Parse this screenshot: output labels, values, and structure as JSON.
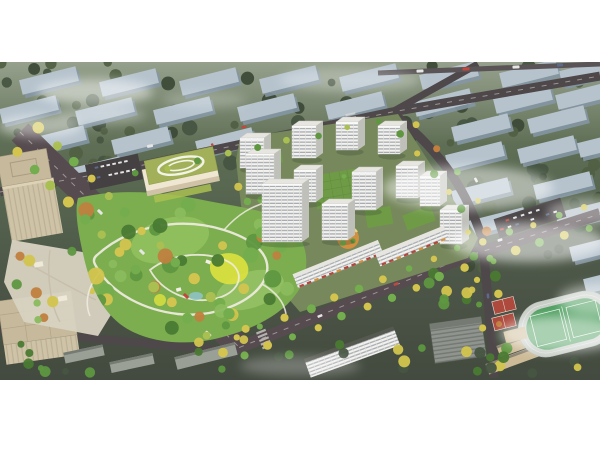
{
  "palette": {
    "white": "#ffffff",
    "base_top": "#6d7c60",
    "base_mid": "#5a6a52",
    "base_low": "#4d5748",
    "base_bottom": "#434a3f",
    "faded_slab_top": "#b6c3cd",
    "faded_slab_side": "#8496a4",
    "tree_dark1": "#3c4a37",
    "tree_dark2": "#465541",
    "tree_dark3": "#516043",
    "road": "#4e484a",
    "road_blvd": "#564c50",
    "road_top": "#5a5456",
    "lane": "#d8d4d0",
    "park_base": "#7cad4e",
    "park_light": "#93c262",
    "park_light2": "#a4cc72",
    "park_yellow": "#d9df3f",
    "path": "#efece1",
    "pond": "#8fc3cd",
    "t_green1": "#4a7a33",
    "t_green2": "#5e9740",
    "t_green3": "#74ad4d",
    "t_green4": "#8abb5d",
    "t_yellow": "#d2c44e",
    "t_orange": "#c07f3e",
    "t_lime": "#aabf52",
    "tower_face": "#f3f2ee",
    "tower_side": "#bfc0ba",
    "tower_roof": "#e6e5e0",
    "tower_roof_edge": "#cac9c3",
    "tower_window": "#99a0a7",
    "podium": "#6f9b47",
    "podium_line": "#5d8a3c",
    "school_wall": "#efe7d1",
    "school_wall_shade": "#cfc2a6",
    "school_roof": "#a2b05a",
    "school_roof_line": "#f2f4e6",
    "parking": "#454041",
    "beige_wall": "#cfc3a7",
    "beige_roof": "#c6b99c",
    "beige_line": "#aa9d81",
    "plaza": "#d8d2c1",
    "grey_bld": "#9aa096",
    "grey_roof": "#757b72",
    "grey_office": "#8f948e",
    "grey_office_line": "#6e736c",
    "white_slab_roof": "#56594f",
    "track": "#c9cfc8",
    "field": "#4f9f60",
    "court_red": "#ad4a3d",
    "tan_school": "#cdbb97",
    "tan_edge": "#8d8472",
    "awning_red": "#b5463f",
    "court_orange": "#d68f3e",
    "dev_ground": "#76885c",
    "car_white": "#e6e6e6",
    "car_red": "#c0483e",
    "car_blue": "#5a6b8c",
    "fog": "#ffffff"
  },
  "scene": {
    "frame": {
      "width": 600,
      "height": 450,
      "content_top": 62,
      "content_height": 318
    },
    "faded_slabs": [
      [
        20,
        73
      ],
      [
        100,
        75
      ],
      [
        180,
        74
      ],
      [
        260,
        72
      ],
      [
        340,
        70
      ],
      [
        420,
        68
      ],
      [
        500,
        66
      ],
      [
        560,
        64
      ],
      [
        0,
        102
      ],
      [
        76,
        104
      ],
      [
        154,
        103
      ],
      [
        238,
        100
      ],
      [
        326,
        98
      ],
      [
        414,
        95
      ],
      [
        494,
        92
      ],
      [
        556,
        88
      ],
      [
        28,
        132
      ],
      [
        112,
        133
      ],
      [
        196,
        134
      ],
      [
        452,
        120
      ],
      [
        528,
        112
      ],
      [
        2,
        160
      ],
      [
        64,
        163
      ],
      [
        446,
        148
      ],
      [
        518,
        142
      ],
      [
        578,
        136
      ],
      [
        452,
        184
      ],
      [
        534,
        178
      ],
      [
        468,
        214
      ],
      [
        556,
        206
      ],
      [
        570,
        240
      ],
      [
        584,
        272
      ]
    ],
    "tree_regions": [
      {
        "r": [
          0,
          62,
          600,
          105
        ],
        "n": 64,
        "rad": [
          3.5,
          8
        ],
        "cols": [
          "tree_dark1",
          "tree_dark2",
          "tree_dark3"
        ],
        "seed": 3,
        "g": "g-bgtrees"
      },
      {
        "r": [
          432,
          168,
          168,
          112
        ],
        "n": 24,
        "rad": [
          3.5,
          8
        ],
        "cols": [
          "tree_dark1",
          "tree_dark2",
          "tree_dark3"
        ],
        "seed": 5,
        "g": "g-bgtrees"
      },
      {
        "r": [
          0,
          118,
          148,
          66
        ],
        "n": 12,
        "rad": [
          3.5,
          7
        ],
        "cols": [
          "tree_dark2",
          "tree_dark3"
        ],
        "seed": 9,
        "g": "g-bgtrees"
      },
      {
        "r": [
          84,
          198,
          226,
          140
        ],
        "n": 46,
        "rad": [
          4,
          9
        ],
        "cols": [
          "t_green1",
          "t_green2",
          "t_green3",
          "t_green4",
          "t_yellow",
          "t_orange"
        ],
        "seed": 21,
        "g": "g-parktrees"
      },
      {
        "r": [
          238,
          150,
          56,
          62
        ],
        "n": 8,
        "rad": [
          3,
          6
        ],
        "cols": [
          "t_green2",
          "t_green3",
          "t_yellow"
        ],
        "seed": 27,
        "g": "g-devtrees"
      },
      {
        "r": [
          16,
          248,
          96,
          72
        ],
        "n": 12,
        "rad": [
          3,
          6
        ],
        "cols": [
          "t_green2",
          "t_green4",
          "t_yellow",
          "t_orange"
        ],
        "seed": 35,
        "g": "g-plazatrees"
      },
      {
        "r": [
          0,
          338,
          600,
          36
        ],
        "n": 30,
        "rad": [
          3,
          6
        ],
        "cols": [
          "tree_dark2",
          "t_green1",
          "t_green2",
          "t_yellow"
        ],
        "seed": 31,
        "g": "g-bottomtrees"
      },
      {
        "r": [
          428,
          258,
          70,
          56
        ],
        "n": 9,
        "rad": [
          3,
          6
        ],
        "cols": [
          "t_green1",
          "t_green2",
          "t_yellow"
        ],
        "seed": 33,
        "g": "g-bottomtrees"
      }
    ],
    "roads": [
      {
        "d": "M 0,192 L 120,170 L 392,112 L 600,76",
        "w": 9,
        "c": "road"
      },
      {
        "d": "M 392,112 L 478,64",
        "w": 7,
        "c": "road"
      },
      {
        "d": "M 378,73 L 600,64",
        "w": 5,
        "c": "road_top"
      },
      {
        "d": "M 394,114 C 448,158 468,196 482,238 C 486,270 488,305 492,345 L 494,378",
        "w": 9,
        "c": "road"
      },
      {
        "d": "M 20,132 L 242,350",
        "w": 24,
        "c": "road_blvd"
      },
      {
        "d": "M 228,352 L 468,256 L 600,214",
        "w": 12,
        "c": "road_blvd"
      },
      {
        "d": "M 0,330 L 230,351",
        "w": 8,
        "c": "road"
      }
    ],
    "lanes": [
      {
        "d": "M 20,132 L 242,350"
      },
      {
        "d": "M 228,352 L 468,256 L 600,214"
      },
      {
        "d": "M 0,192 L 120,170 L 392,112 L 600,76"
      }
    ],
    "crosswalks": [
      {
        "x": 96,
        "y": 206,
        "rot": 45
      },
      {
        "x": 190,
        "y": 300,
        "rot": 45
      },
      {
        "x": 352,
        "y": 122,
        "rot": 78
      },
      {
        "x": 264,
        "y": 339,
        "rot": 68
      }
    ],
    "towers": [
      [
        240,
        138,
        24,
        30
      ],
      [
        292,
        126,
        24,
        32
      ],
      [
        336,
        122,
        22,
        28
      ],
      [
        378,
        126,
        22,
        28
      ],
      [
        246,
        154,
        28,
        40
      ],
      [
        294,
        170,
        22,
        32
      ],
      [
        352,
        172,
        24,
        38
      ],
      [
        396,
        166,
        22,
        32
      ],
      [
        262,
        184,
        40,
        58
      ],
      [
        322,
        204,
        26,
        36
      ],
      [
        420,
        176,
        20,
        30
      ],
      [
        440,
        210,
        22,
        34
      ]
    ],
    "slabs": [
      {
        "cx": 338,
        "cy": 264,
        "rot": -22,
        "w": 92,
        "h": 15,
        "kind": "shop"
      },
      {
        "cx": 412,
        "cy": 246,
        "rot": -22,
        "w": 74,
        "h": 14,
        "kind": "shop"
      },
      {
        "cx": 352,
        "cy": 352,
        "rot": -20,
        "w": 95,
        "h": 20,
        "kind": "white"
      },
      {
        "cx": 206,
        "cy": 356,
        "rot": -14,
        "w": 62,
        "h": 13,
        "kind": "grey"
      },
      {
        "cx": 84,
        "cy": 354,
        "rot": -12,
        "w": 40,
        "h": 11,
        "kind": "grey"
      },
      {
        "cx": 132,
        "cy": 363,
        "rot": -12,
        "w": 44,
        "h": 11,
        "kind": "grey"
      },
      {
        "cx": 536,
        "cy": 338,
        "rot": -20,
        "w": 80,
        "h": 12,
        "kind": "tan"
      },
      {
        "cx": 524,
        "cy": 356,
        "rot": -20,
        "w": 78,
        "h": 11,
        "kind": "tan"
      }
    ],
    "lots": [
      {
        "cx": 114,
        "cy": 172,
        "rot": -12,
        "w": 54,
        "h": 26,
        "rows": 2,
        "cols": 8,
        "seed": 41
      },
      {
        "cx": 530,
        "cy": 218,
        "rot": -18,
        "w": 70,
        "h": 20,
        "rows": 2,
        "cols": 8,
        "seed": 43
      }
    ],
    "street_trees": [
      {
        "pts": [
          [
            20,
            132
          ],
          [
            242,
            350
          ]
        ],
        "n": 13,
        "off": -16,
        "rad": 4.5,
        "cols": [
          "t_yellow",
          "t_lime",
          "t_green3"
        ],
        "seed": 7
      },
      {
        "pts": [
          [
            20,
            132
          ],
          [
            242,
            350
          ]
        ],
        "n": 13,
        "off": 16,
        "rad": 4.5,
        "cols": [
          "t_yellow",
          "t_green3",
          "t_lime"
        ],
        "seed": 11
      },
      {
        "pts": [
          [
            228,
            352
          ],
          [
            468,
            256
          ],
          [
            600,
            214
          ]
        ],
        "n": 15,
        "off": -10,
        "rad": 3.8,
        "cols": [
          "t_yellow",
          "t_green3"
        ],
        "seed": 13
      },
      {
        "pts": [
          [
            228,
            352
          ],
          [
            468,
            256
          ],
          [
            600,
            214
          ]
        ],
        "n": 15,
        "off": 10,
        "rad": 3.8,
        "cols": [
          "t_green3",
          "t_yellow"
        ],
        "seed": 17
      },
      {
        "pts": [
          [
            120,
            170
          ],
          [
            392,
            112
          ]
        ],
        "n": 9,
        "off": 7,
        "rad": 3.2,
        "cols": [
          "t_green2",
          "t_lime"
        ],
        "seed": 19
      },
      {
        "pts": [
          [
            400,
            120
          ],
          [
            470,
            200
          ],
          [
            486,
            268
          ],
          [
            492,
            340
          ]
        ],
        "n": 10,
        "off": 9,
        "rad": 3.4,
        "cols": [
          "t_green2",
          "t_yellow"
        ],
        "seed": 23
      },
      {
        "pts": [
          [
            400,
            120
          ],
          [
            470,
            200
          ],
          [
            486,
            268
          ],
          [
            492,
            340
          ]
        ],
        "n": 8,
        "off": -9,
        "rad": 3.6,
        "cols": [
          "t_yellow",
          "t_orange",
          "t_green3"
        ],
        "seed": 29
      }
    ],
    "cars": [
      [
        150,
        146,
        -12,
        6,
        3,
        "car_white"
      ],
      [
        244,
        127,
        -12,
        5,
        2.5,
        "car_red"
      ],
      [
        100,
        212,
        44,
        6,
        3,
        "car_white"
      ],
      [
        142,
        252,
        44,
        6,
        3,
        "car_white"
      ],
      [
        186,
        296,
        44,
        6,
        3,
        "car_red"
      ],
      [
        208,
        334,
        44,
        7,
        3.5,
        "car_white"
      ],
      [
        320,
        316,
        -22,
        5,
        2.5,
        "car_white"
      ],
      [
        396,
        284,
        -22,
        5,
        2.5,
        "car_red"
      ],
      [
        500,
        240,
        -17,
        5,
        2.5,
        "car_white"
      ],
      [
        476,
        180,
        62,
        5,
        2.5,
        "car_white"
      ],
      [
        488,
        296,
        86,
        5,
        2.5,
        "car_blue"
      ],
      [
        420,
        71,
        -2,
        7,
        3,
        "car_white"
      ],
      [
        466,
        69,
        -2,
        7,
        3,
        "car_red"
      ],
      [
        516,
        67,
        -2,
        7,
        3,
        "car_white"
      ],
      [
        560,
        65,
        -2,
        6,
        3,
        "car_blue"
      ]
    ],
    "fog": [
      [
        95,
        92,
        58,
        13,
        0.5
      ],
      [
        40,
        126,
        42,
        11,
        0.45
      ],
      [
        350,
        80,
        70,
        12,
        0.28
      ],
      [
        468,
        188,
        85,
        22,
        0.5
      ],
      [
        528,
        242,
        78,
        20,
        0.55
      ],
      [
        588,
        212,
        42,
        14,
        0.4
      ],
      [
        562,
        334,
        62,
        18,
        0.52
      ],
      [
        600,
        300,
        42,
        16,
        0.45
      ],
      [
        100,
        115,
        45,
        9,
        0.3
      ],
      [
        205,
        100,
        42,
        8,
        0.22
      ],
      [
        300,
        366,
        60,
        10,
        0.25
      ]
    ]
  }
}
